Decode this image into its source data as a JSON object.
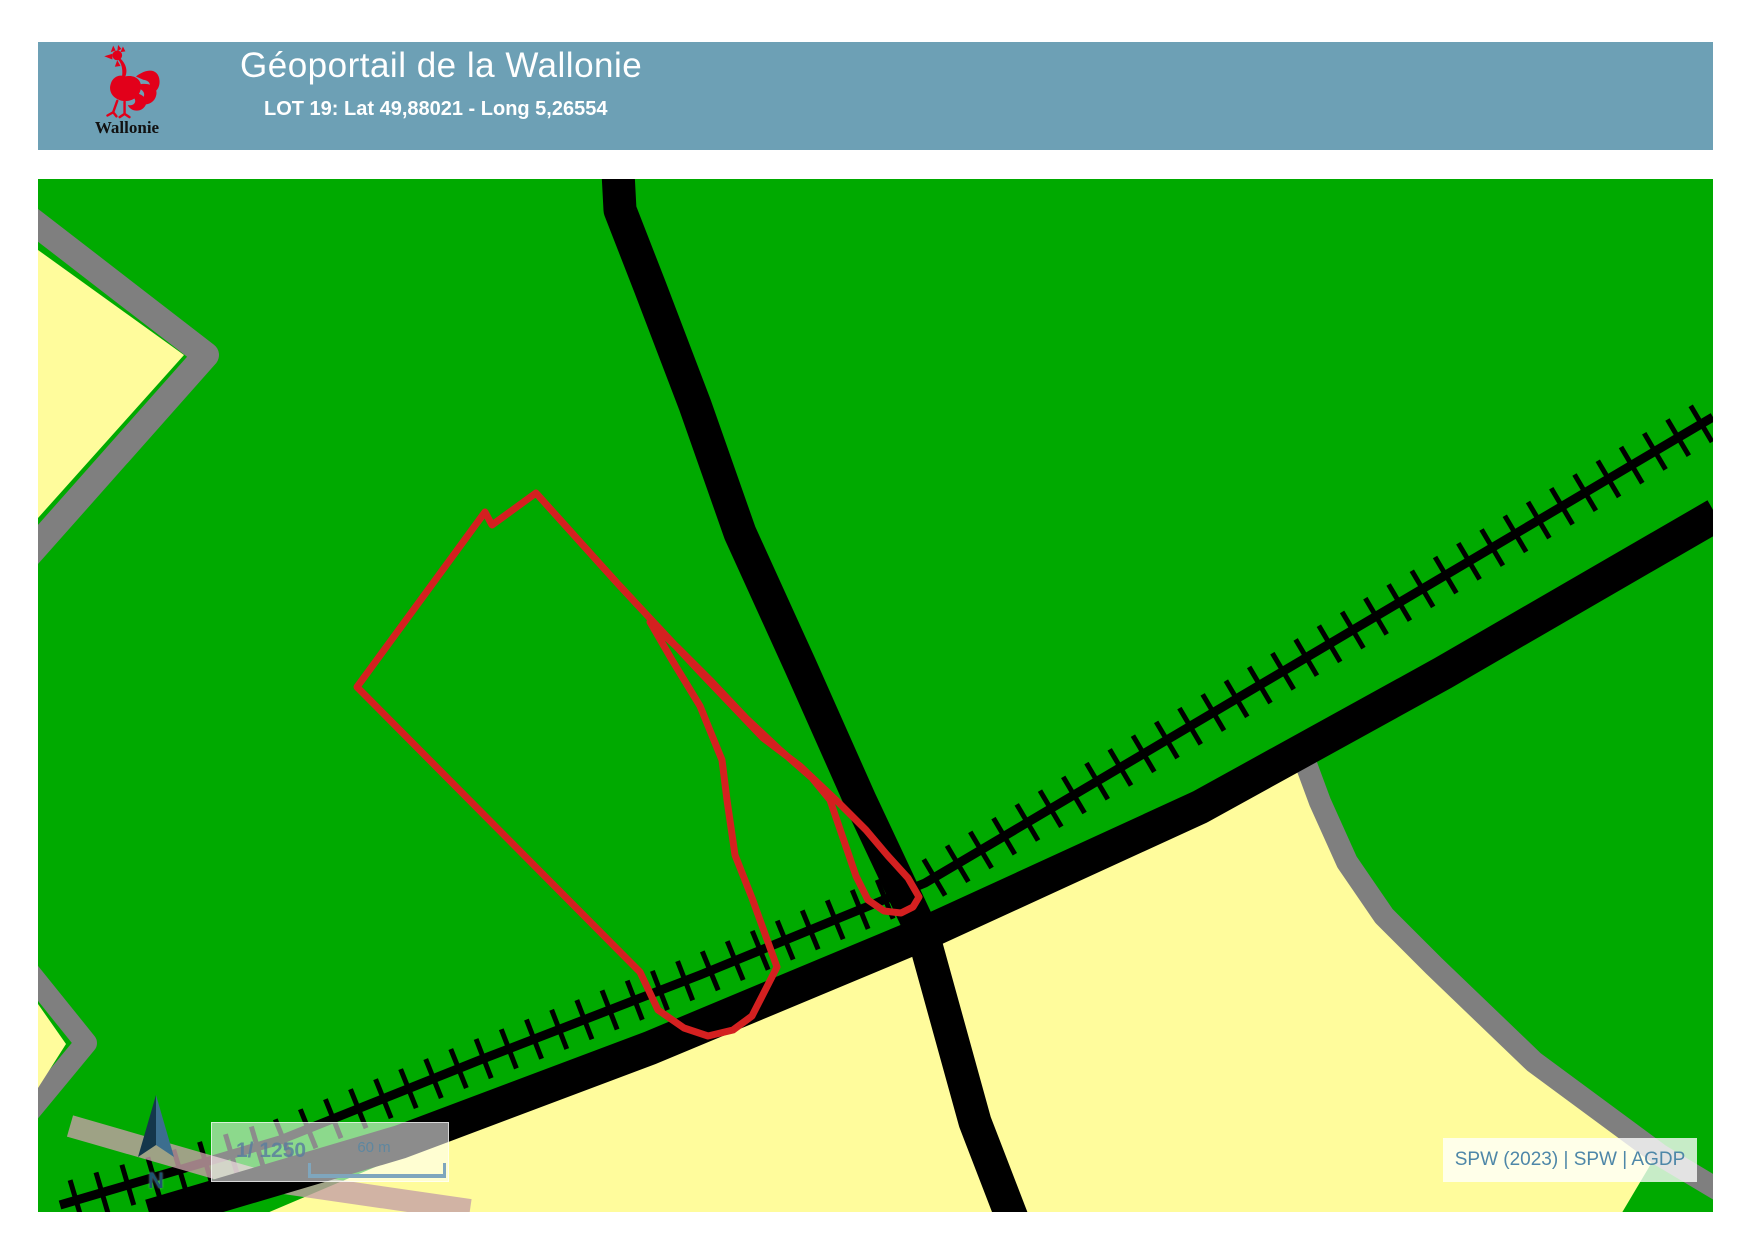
{
  "header": {
    "title": "Géoportail de la Wallonie",
    "subtitle": "LOT 19: Lat 49,88021 - Long 5,26554",
    "logo_label": "Wallonie",
    "background_color": "#6DA0B5",
    "text_color": "#FFFFFF",
    "logo_color": "#E2001A"
  },
  "map": {
    "north_label": "N",
    "scale": {
      "ratio_label": "1/ 1250",
      "bar_label": "60 m"
    },
    "attribution": "SPW (2023) | SPW | AGDP",
    "colors": {
      "field_green": "#00AA00",
      "field_yellow": "#FFFC9C",
      "road_gray": "#7F7F7F",
      "road_black": "#000000",
      "railway_black": "#000000",
      "overlay_pink": "rgba(198,160,166,0.8)",
      "parcel_red": "#D42020"
    },
    "features": [
      {
        "name": "field-yellow-south",
        "kind": "polygon",
        "color": "#FFFC9C",
        "points": [
          [
            923,
            934
          ],
          [
            1300,
            762
          ],
          [
            1338,
            842
          ],
          [
            1380,
            910
          ],
          [
            1430,
            962
          ],
          [
            1532,
            1060
          ],
          [
            1658,
            1152
          ],
          [
            1620,
            1216
          ],
          [
            260,
            1216
          ]
        ]
      },
      {
        "name": "boundary-gray-southeast",
        "kind": "line",
        "color": "#7F7F7F",
        "width": 22,
        "points": [
          [
            1303,
            756
          ],
          [
            1320,
            802
          ],
          [
            1347,
            862
          ],
          [
            1384,
            916
          ],
          [
            1434,
            966
          ],
          [
            1534,
            1062
          ],
          [
            1660,
            1155
          ],
          [
            1722,
            1192
          ]
        ]
      },
      {
        "name": "boundary-gray-west-wedge",
        "kind": "line",
        "color": "#7F7F7F",
        "width": 26,
        "points": [
          [
            26,
            216
          ],
          [
            206,
            355
          ],
          [
            26,
            558
          ]
        ]
      },
      {
        "name": "field-yellow-west",
        "kind": "polygon",
        "color": "#FFFC9C",
        "points": [
          [
            38,
            250
          ],
          [
            184,
            355
          ],
          [
            38,
            518
          ]
        ]
      },
      {
        "name": "boundary-gray-southwest-wedge",
        "kind": "line",
        "color": "#7F7F7F",
        "width": 22,
        "points": [
          [
            24,
            966
          ],
          [
            86,
            1043
          ],
          [
            24,
            1118
          ]
        ]
      },
      {
        "name": "field-yellow-southwest",
        "kind": "polygon",
        "color": "#FFFC9C",
        "points": [
          [
            38,
            1004
          ],
          [
            66,
            1044
          ],
          [
            38,
            1088
          ]
        ]
      },
      {
        "name": "railway-line",
        "kind": "railway",
        "color": "#000000",
        "width": 9,
        "tick_len": 21,
        "tick_width": 5,
        "tick_spacing": 27,
        "points": [
          [
            1713,
            417
          ],
          [
            925,
            883
          ],
          [
            700,
            975
          ],
          [
            480,
            1060
          ],
          [
            280,
            1140
          ],
          [
            60,
            1205
          ]
        ]
      },
      {
        "name": "railway-road-overlay-pink",
        "kind": "line",
        "color": "rgba(198,160,166,0.8)",
        "width": 22,
        "points": [
          [
            70,
            1126
          ],
          [
            250,
            1178
          ],
          [
            470,
            1210
          ]
        ]
      },
      {
        "name": "road-main-diagonal",
        "kind": "line",
        "color": "#000000",
        "width": 34,
        "points": [
          [
            1716,
            515
          ],
          [
            1443,
            673
          ],
          [
            1200,
            807
          ],
          [
            923,
            934
          ],
          [
            650,
            1048
          ],
          [
            400,
            1142
          ],
          [
            150,
            1216
          ]
        ]
      },
      {
        "name": "road-north-south",
        "kind": "line",
        "color": "#000000",
        "width": 33,
        "points": [
          [
            618,
            172
          ],
          [
            620,
            210
          ],
          [
            650,
            287
          ],
          [
            695,
            405
          ],
          [
            740,
            533
          ],
          [
            800,
            665
          ],
          [
            860,
            800
          ],
          [
            923,
            934
          ],
          [
            975,
            1122
          ],
          [
            1012,
            1218
          ]
        ]
      },
      {
        "name": "parcel-lot19-outline",
        "kind": "line",
        "close": true,
        "color": "#D42020",
        "width": 7,
        "points": [
          [
            536,
            493
          ],
          [
            492,
            525
          ],
          [
            485,
            512
          ],
          [
            357,
            687
          ],
          [
            640,
            972
          ],
          [
            658,
            1010
          ],
          [
            684,
            1028
          ],
          [
            708,
            1036
          ],
          [
            733,
            1030
          ],
          [
            752,
            1016
          ],
          [
            777,
            967
          ],
          [
            752,
            898
          ],
          [
            735,
            855
          ],
          [
            727,
            800
          ],
          [
            722,
            760
          ],
          [
            700,
            706
          ],
          [
            672,
            660
          ],
          [
            650,
            622
          ],
          [
            678,
            648
          ],
          [
            712,
            682
          ],
          [
            746,
            718
          ],
          [
            780,
            750
          ],
          [
            812,
            778
          ],
          [
            830,
            800
          ],
          [
            843,
            838
          ],
          [
            856,
            876
          ],
          [
            868,
            900
          ],
          [
            884,
            911
          ],
          [
            901,
            913
          ],
          [
            913,
            907
          ],
          [
            919,
            897
          ],
          [
            908,
            878
          ],
          [
            888,
            856
          ],
          [
            866,
            830
          ],
          [
            836,
            800
          ],
          [
            800,
            766
          ],
          [
            763,
            738
          ],
          [
            700,
            672
          ],
          [
            618,
            584
          ]
        ]
      }
    ]
  }
}
